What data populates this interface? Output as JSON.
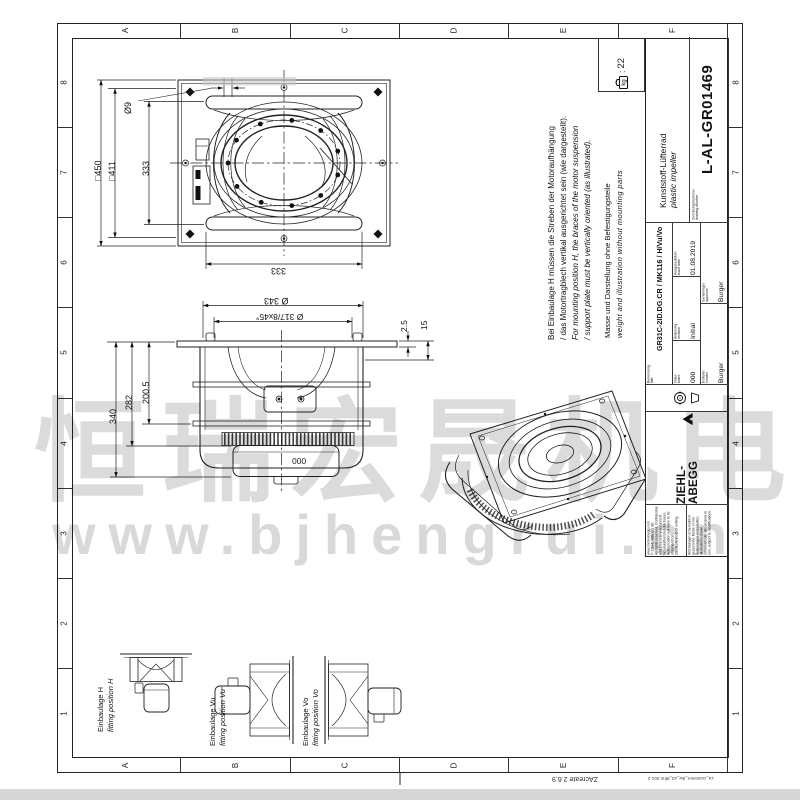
{
  "sheet": {
    "border": {
      "columns": [
        "A",
        "B",
        "C",
        "D",
        "E",
        "F"
      ],
      "rows": [
        "8",
        "7",
        "6",
        "5",
        "4",
        "3",
        "2",
        "1"
      ]
    },
    "footer": {
      "app_version": "ZAcreate 2.6.9",
      "template_ref": "za_customer_dw_a3_8frm 001 2"
    }
  },
  "title_block": {
    "company": {
      "logo_text": "ZIEHL-ABEGG",
      "website": "www.ziehl-abegg.com",
      "copyright": "© ZIEHL-ABEGG SE",
      "rights_1": "All rights reserved. Confidential and proprietary document.",
      "rights_2": "No unauthorized disclosure. Authorization will have to be obtained from",
      "rights_3": "ZIEHL-ABEGG in writing.",
      "schematic_note_de": "Abbildungen schematisch gezeichnet. Maße in mm. Änderungen vorbehalten.",
      "schematic_note_en": "Illustrations drawn schematically, dimensions in mm, subject to modifications."
    },
    "fields": {
      "title_label_de": "Benennung",
      "title_label_en": "title",
      "title_value": "GR31C-2ID.DG.CR / MK116 / H/Vu/Vo",
      "index_label_de": "Index",
      "index_label_en": "index",
      "index_value": "000",
      "revision_label_de": "Änderung",
      "revision_label_en": "revision",
      "revision_value": "Initial",
      "issue_date_label_de": "Ausgabedatum",
      "issue_date_label_en": "issue date",
      "issue_date_value": "01.08.2019",
      "creator_label_de": "Ersteller",
      "creator_label_en": "creator",
      "creator_value": "Burger",
      "approver_label_de": "Genehmiger",
      "approver_label_en": "approver",
      "approver_value": "Burger",
      "drawing_no_label_de": "Zeichnungsnummer",
      "drawing_no_label_en": "drawing number",
      "drawing_no_value": "L-AL-GR01469",
      "product_name_de": "Kunststoff-Lüfterrad",
      "product_name_en": "plastic impeller"
    }
  },
  "notes": {
    "position_de_1": "Bei Einbaulage H müssen die Streben der Motoraufhängung",
    "position_de_2": "/ das Motortragblech vertikal ausgerichtet sein (wie dargestellt).",
    "position_en_1": "For mounting position H, the braces of the motor suspension",
    "position_en_2": "/ support plate must be vertically oriented (as illustrated).",
    "weight_note_de": "Masse und Darstellung ohne Befestigungsteile",
    "weight_note_en": "weight and illustration without mounting parts"
  },
  "weight": {
    "unit": "kg",
    "separator": ":",
    "value": "22"
  },
  "dimensions": {
    "front": {
      "outer_square": "□450",
      "bolt_square": "□411",
      "height_333": "333",
      "hole_dia": "Ø9",
      "width_333": "333"
    },
    "side": {
      "total_height": "340",
      "housing_height": "282",
      "flange_height": "200.5",
      "outer_dia": "Ø 343",
      "bolt_circle": "Ø 317/8x45°",
      "plate_thickness": "2.5",
      "offset": "15",
      "motor_marking": "000"
    }
  },
  "fitting_positions": [
    {
      "de": "Einbaulage H",
      "en": "fitting position H"
    },
    {
      "de": "Einbaulage Vu",
      "en": "fitting position Vu"
    },
    {
      "de": "Einbaulage Vo",
      "en": "fitting position Vo"
    }
  ],
  "watermark": {
    "chinese": "恒瑞宏晟机电",
    "url": "www.bjhengrui.cn"
  }
}
